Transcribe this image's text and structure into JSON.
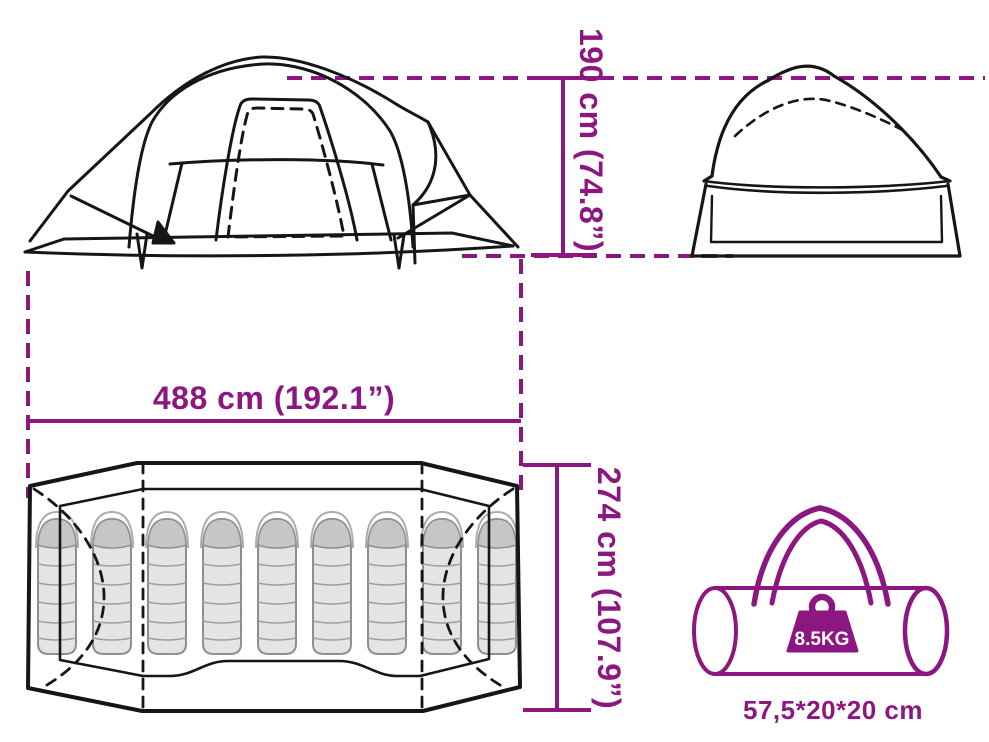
{
  "diagram": {
    "kind": "tent-product-dimension-diagram",
    "accent_color": "#8D1781",
    "line_color": "#161616",
    "dimensions": {
      "height": {
        "label": "190 cm (74.8”)"
      },
      "width": {
        "label": "488 cm (192.1”)"
      },
      "depth": {
        "label": "274 cm (107.9”)"
      }
    },
    "floor_plan": {
      "sleeping_bag_count": 9
    },
    "carry_bag": {
      "weight_label": "8.5KG",
      "size_label": "57,5*20*20 cm"
    }
  }
}
